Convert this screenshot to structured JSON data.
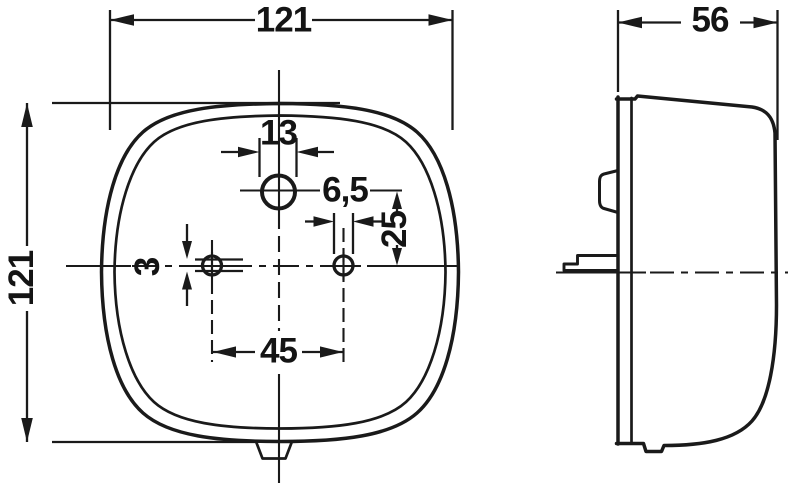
{
  "drawing": {
    "kind": "lamp-dimensional-drawing",
    "colors": {
      "ink": "#1a1a1a",
      "background": "#ffffff"
    },
    "front_view": {
      "width": "121",
      "height": "121",
      "top_hole_diameter": "13",
      "mount_hole_diameter": "6,5",
      "top_hole_offset": "25",
      "slot_height": "3",
      "mount_hole_spacing": "45"
    },
    "side_view": {
      "depth": "56"
    }
  }
}
